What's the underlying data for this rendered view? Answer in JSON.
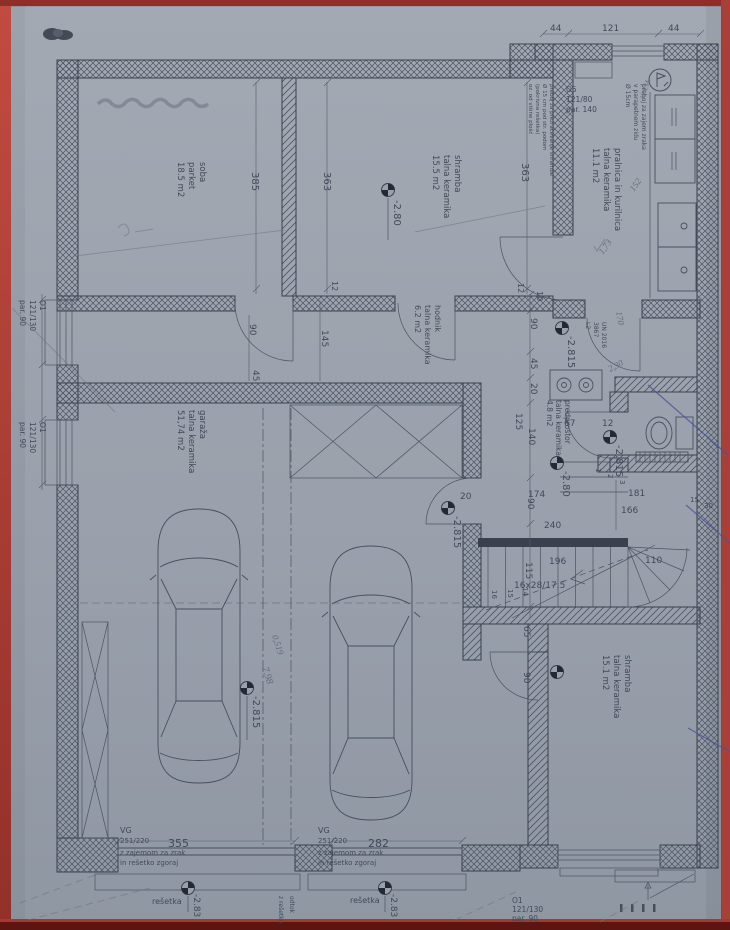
{
  "plan": {
    "rooms": {
      "soba": [
        "soba",
        "parket",
        "18.5 m2"
      ],
      "shramba_zgoraj": [
        "shramba",
        "talna keramika",
        "15.5 m2"
      ],
      "pralnica": [
        "pralnica in kurilnica",
        "talna keramika",
        "11.1 m2"
      ],
      "hodnik": [
        "hodnik",
        "talna keramika",
        "6.2 m2"
      ],
      "garaza": [
        "garaža",
        "talna keramika",
        "51,74 m2"
      ],
      "predprostor": [
        "predprostor",
        "talna keramika",
        "4.8 m2"
      ],
      "shramba_spodaj": [
        "shramba",
        "talna keramika",
        "15.1 m2"
      ]
    },
    "openings": {
      "o5": [
        "O5",
        "121/80",
        "par. 140"
      ],
      "o1_levo_1": [
        "O1",
        "121/130",
        "par. 90"
      ],
      "o1_levo_2": [
        "O1",
        "121/130",
        "par. 90"
      ],
      "o1_spodaj": [
        "O1",
        "121/130",
        "par. 90"
      ],
      "vg_levo": [
        "VG",
        "251/220",
        "z zajemom za zrak",
        "in rešetko zgoraj"
      ],
      "vg_desno": [
        "VG",
        "251/220",
        "z zajemom za zrak",
        "in rešetko zgoraj"
      ],
      "un_vrata": [
        "UN 2016",
        "3867",
        "L2"
      ],
      "resetka": "rešetka"
    },
    "notes": {
      "preboj_shramba": [
        "preboj za prezračevanje shrambe",
        "Ø 15 cm pod str. podom",
        "(pokrivna rešetka)",
        "oz. od višine plošč"
      ],
      "preboj_parapet": [
        "preboj za zajem zraka",
        "v parapetnem zidu",
        "Ø 15cm"
      ],
      "odtok": "odtok",
      "z_resetko": "z rešetko"
    },
    "dims": {
      "top": [
        "44",
        "121",
        "44"
      ],
      "soba_visina": "385",
      "shramba_sirina": "363",
      "shramba_sirina2": "363",
      "vrata_12": "12",
      "vrata_90": "90",
      "vrata_45": "45",
      "vrata_145": "145",
      "c12": "12",
      "c10": "10",
      "c90": "90",
      "c45": "45",
      "c20": "20",
      "c125": "125",
      "c140": "140",
      "c174": "174",
      "c90b": "90",
      "c240": "240",
      "c196": "196",
      "c115": "115",
      "c20b": "20",
      "p67": "67",
      "p12": "12",
      "s181": "181",
      "s166": "166",
      "s110": "110",
      "s15": "15",
      "s30": "30",
      "k65": "65",
      "k90": "90",
      "vg355": "355",
      "vg282": "282"
    },
    "stairs": {
      "spec": "16x28/17.5",
      "n14": "14",
      "n15": "15",
      "n16": "16",
      "n1": "1",
      "n2": "2",
      "n3": "3"
    },
    "levels": {
      "l280a": "-2.80",
      "l2815a": "-2.815",
      "l280b": "-2.80",
      "l2815b": "-2.815",
      "l2815c": "-2.815",
      "l2815d": "-2.815",
      "l283a": "-2.83",
      "l283b": "-2.83"
    },
    "handwriting": {
      "h152": "152",
      "h173": "1,73",
      "h170": "170",
      "h230": "2,30",
      "h519": "0,519",
      "h798": "7,98",
      "hkm": "12 k.M."
    }
  }
}
